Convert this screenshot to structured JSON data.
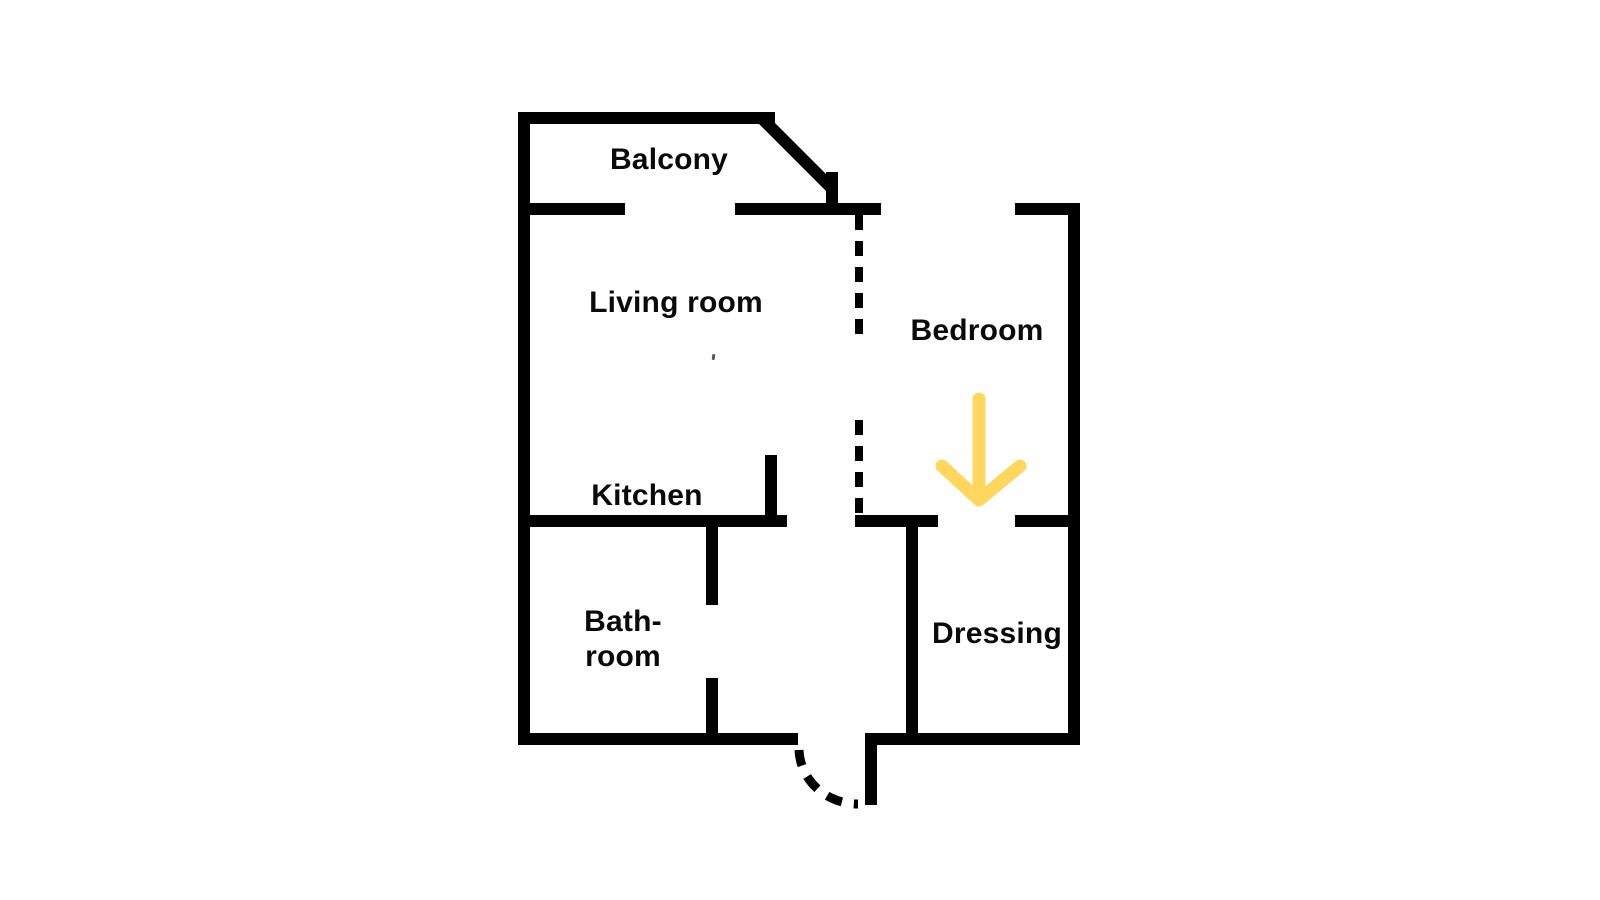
{
  "diagram": {
    "type": "floor-plan",
    "rooms": [
      {
        "name": "balcony",
        "label": "Balcony"
      },
      {
        "name": "living-room",
        "label": "Living room"
      },
      {
        "name": "kitchen",
        "label": "Kitchen"
      },
      {
        "name": "bathroom",
        "label_line1": "Bath-",
        "label_line2": "room"
      },
      {
        "name": "bedroom",
        "label": "Bedroom"
      },
      {
        "name": "dressing",
        "label": "Dressing"
      }
    ],
    "annotations": [
      {
        "name": "arrow-down",
        "meaning": "highlights dressing-room entrance from bedroom"
      }
    ],
    "colors": {
      "wall": "#000000",
      "background": "#FFFFFF",
      "text": "#0A0A0A",
      "highlight_arrow": "#FFD75E"
    }
  }
}
